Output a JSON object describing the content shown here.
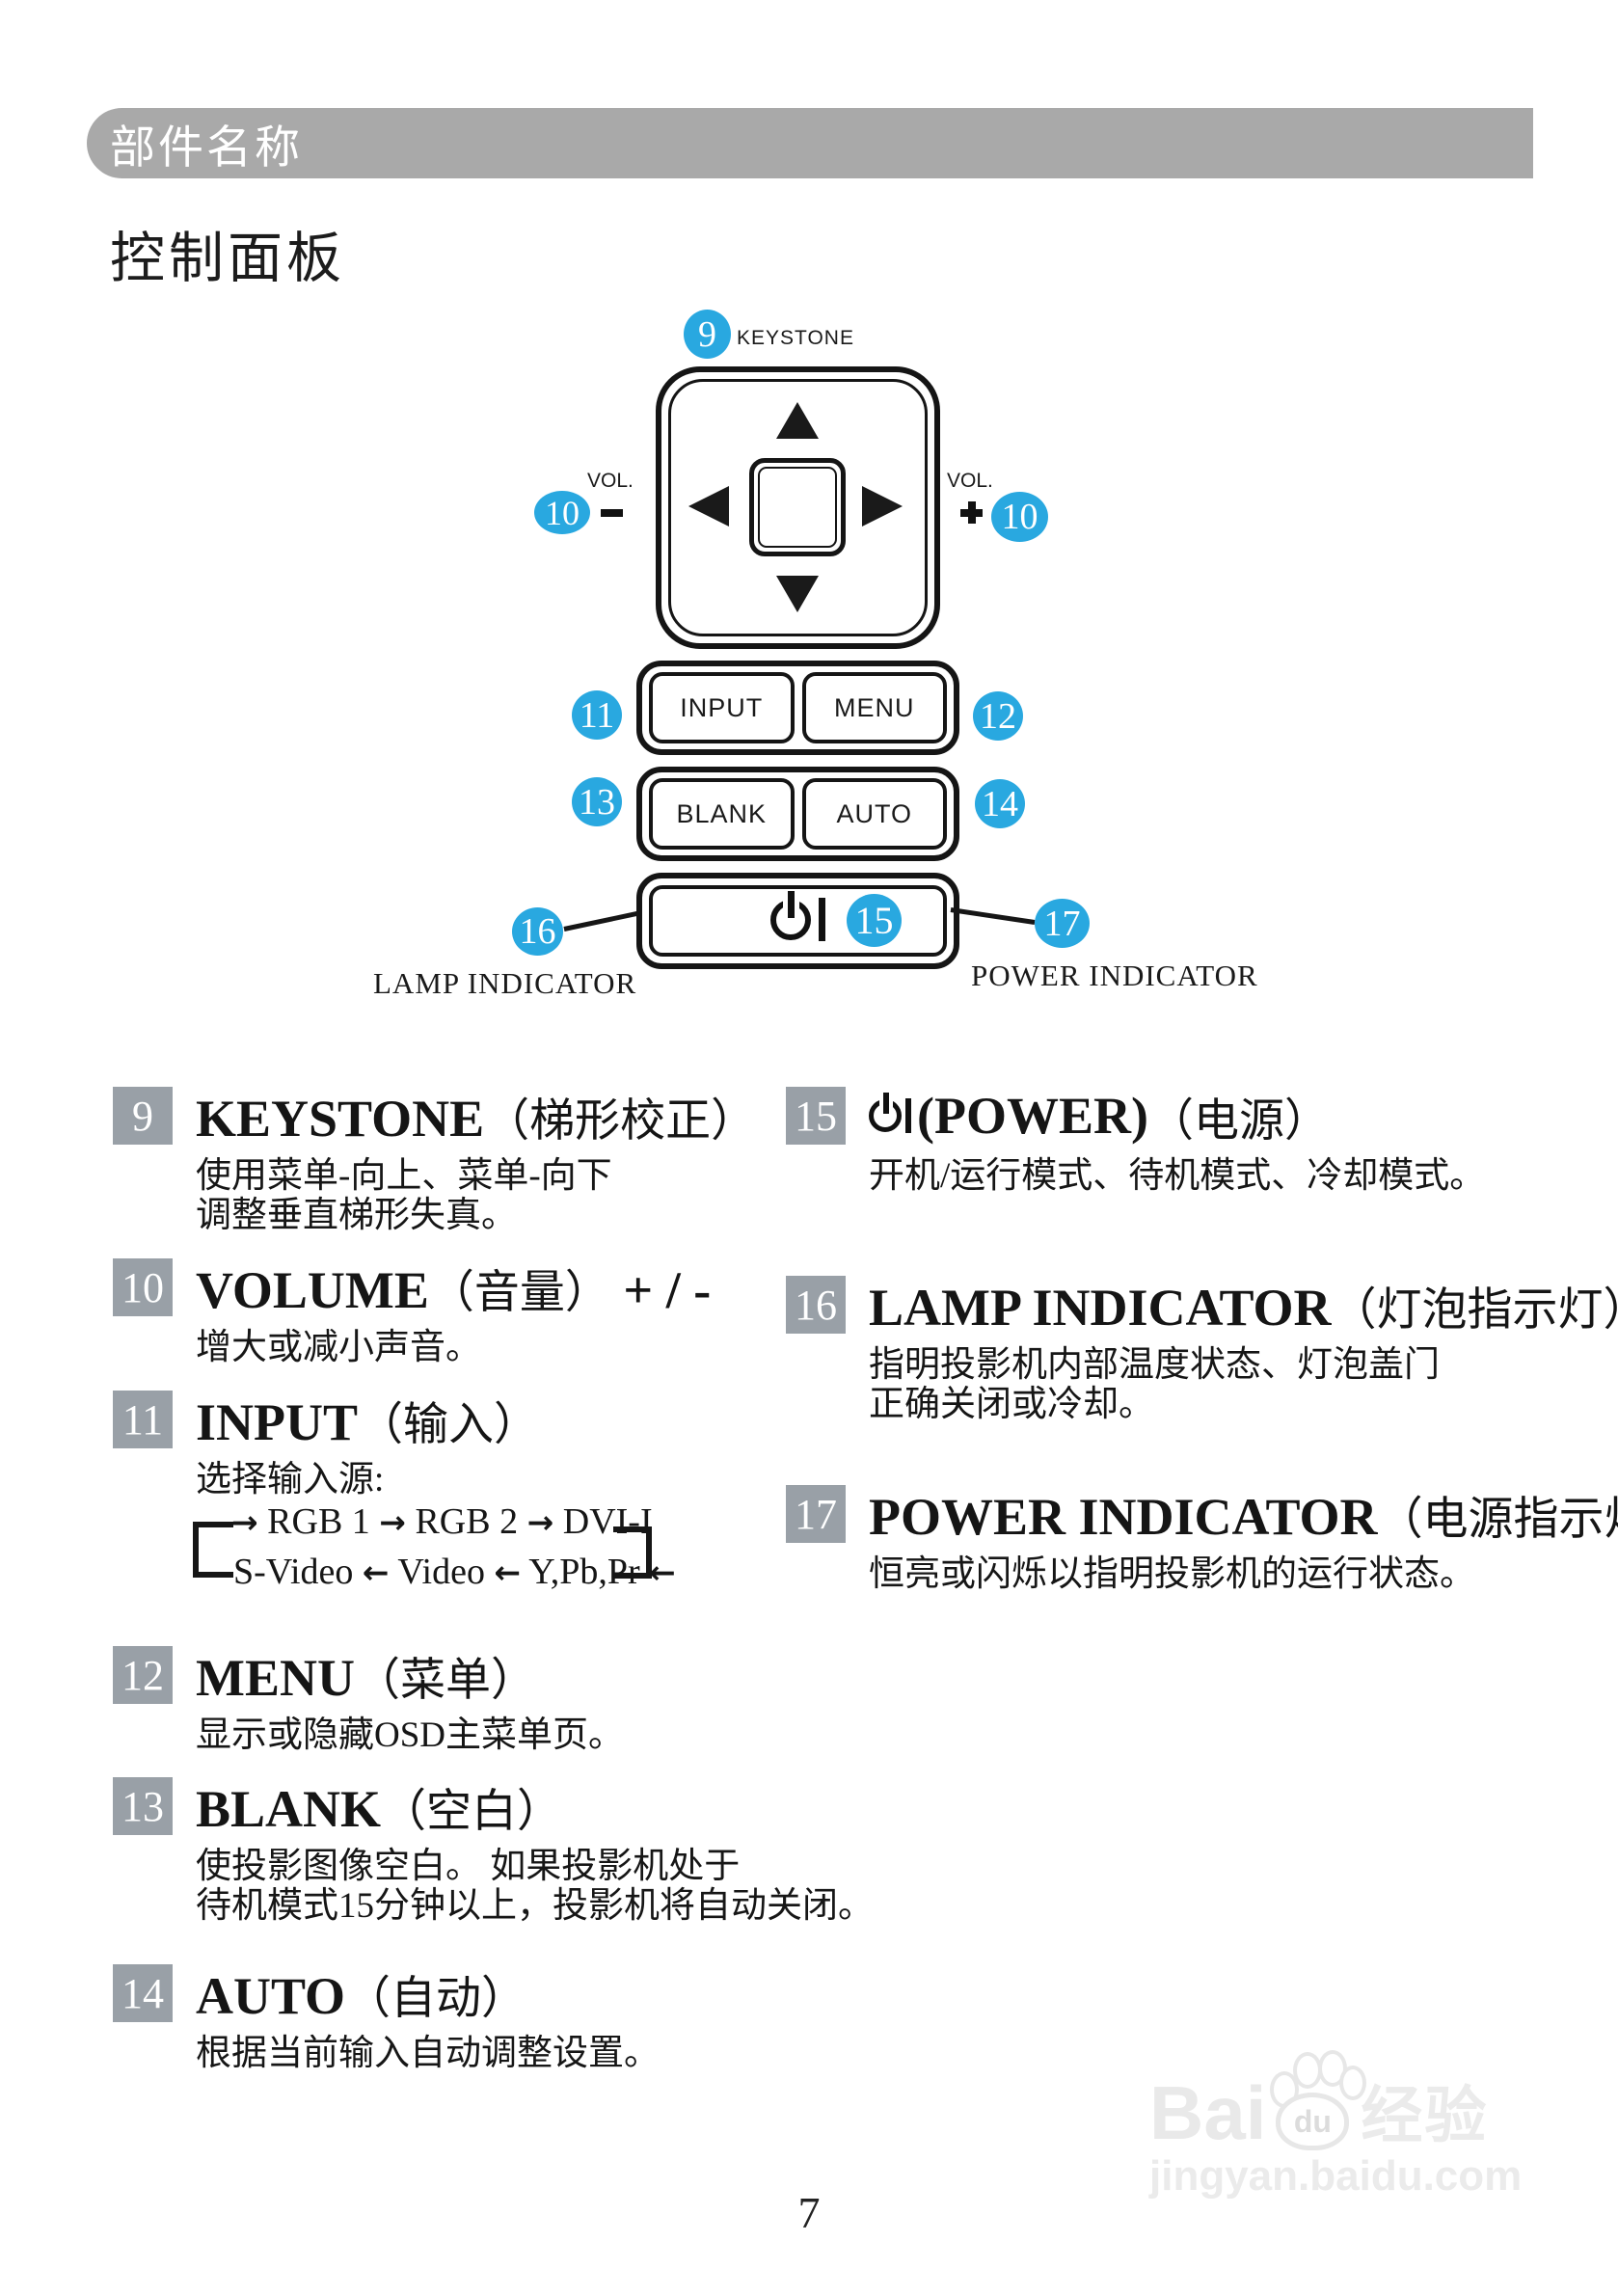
{
  "header": {
    "label": "部件名称"
  },
  "title": "控制面板",
  "diagram": {
    "keystone_label": "KEYSTONE",
    "vol_left_label": "VOL.",
    "vol_right_label": "VOL.",
    "minus_sign": "−",
    "plus_sign": "+",
    "buttons": {
      "input": "INPUT",
      "menu": "MENU",
      "blank": "BLANK",
      "auto": "AUTO"
    },
    "lamp_indicator_label": "LAMP INDICATOR",
    "power_indicator_label": "POWER INDICATOR",
    "badges": {
      "keystone": "9",
      "vol_minus": "10",
      "vol_plus": "10",
      "input": "11",
      "menu": "12",
      "blank": "13",
      "auto": "14",
      "power": "15",
      "lamp": "16",
      "power_indicator": "17"
    }
  },
  "cycle": {
    "arrow_right": "→",
    "arrow_left": "←"
  },
  "items": [
    {
      "num": "9",
      "name": "KEYSTONE",
      "cn": "（梯形校正）",
      "desc": [
        "使用菜单-向上、菜单-向下",
        "调整垂直梯形失真。"
      ]
    },
    {
      "num": "10",
      "name": "VOLUME",
      "cn": "（音量）",
      "suffix": "+ / -",
      "desc": [
        "增大或减小声音。"
      ]
    },
    {
      "num": "11",
      "name": "INPUT",
      "cn": "（输入）",
      "desc": [
        "选择输入源:"
      ],
      "cycle_top": [
        "RGB 1",
        "RGB 2",
        "DVI-I"
      ],
      "cycle_bottom": [
        "S-Video",
        "Video",
        "Y,Pb,Pr"
      ]
    },
    {
      "num": "12",
      "name": "MENU",
      "cn": "（菜单）",
      "desc": [
        "显示或隐藏OSD主菜单页。"
      ]
    },
    {
      "num": "13",
      "name": "BLANK",
      "cn": "（空白）",
      "desc": [
        "使投影图像空白。 如果投影机处于",
        "待机模式15分钟以上，投影机将自动关闭。"
      ]
    },
    {
      "num": "14",
      "name": "AUTO",
      "cn": "（自动）",
      "desc": [
        "根据当前输入自动调整设置。"
      ]
    },
    {
      "num": "15",
      "name": "(POWER)",
      "cn": "（电源）",
      "desc": [
        "开机/运行模式、待机模式、冷却模式。"
      ]
    },
    {
      "num": "16",
      "name": "LAMP INDICATOR",
      "cn": "（灯泡指示灯）",
      "desc": [
        "指明投影机内部温度状态、灯泡盖门",
        "正确关闭或冷却。"
      ]
    },
    {
      "num": "17",
      "name": "POWER INDICATOR",
      "cn": "（电源指示灯）",
      "desc": [
        "恒亮或闪烁以指明投影机的运行状态。"
      ]
    }
  ],
  "page_number": "7",
  "watermark": {
    "brand": "Bai",
    "paw_text": "du",
    "brand_cn": "经验",
    "url": "jingyan.baidu.com"
  },
  "colors": {
    "accent_blue": "#29a8e0",
    "badge_gray": "#99a0a7",
    "bar_gray": "#a9a9a9"
  }
}
